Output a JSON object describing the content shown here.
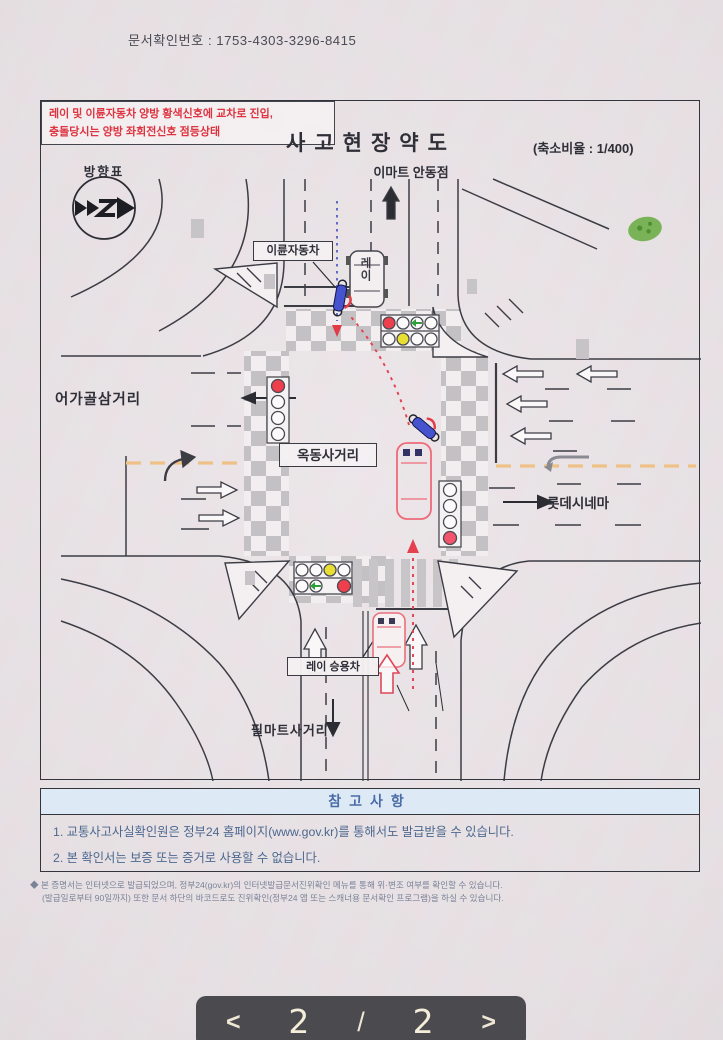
{
  "page": {
    "doc_number": "문서확인번호 : 1753-4303-3296-8415"
  },
  "diagram": {
    "title": "사고현장약도",
    "scale_note": "(축소비율 : 1/400)",
    "compass_label": "방향표",
    "landmark_north": "이마트 안동점",
    "landmark_west": "어가골삼거리",
    "landmark_center": "옥동사거리",
    "landmark_east": "롯데시네마",
    "landmark_south": "필마트사거리",
    "motorcycle_label": "이륜자동차",
    "ray_car_label": "레이 승용차",
    "ray_car_final_text": "레이",
    "incident_line1": "레이 및 이륜자동차 양방 황색신호에 교차로 진입,",
    "incident_line2": "충돌당시는 양방 좌회전신호 점등상태"
  },
  "notes": {
    "header": "참고사항",
    "items": [
      "1. 교통사고사실확인원은 정부24 홈페이지(www.gov.kr)를 통해서도 발급받을 수 있습니다.",
      "2. 본 확인서는 보증 또는 증거로 사용할 수 없습니다."
    ]
  },
  "footnote": {
    "line1": "◆ 본 증명서는 인터넷으로 발급되었으며, 정부24(gov.kr)의 인터넷발급문서진위확인 메뉴를 통해 위·변조 여부를 확인할 수 있습니다.",
    "line2": "(발급일로부터 90일까지) 또한 문서 하단의 바코드로도 진위확인(정부24 앱 또는 스캐너용 문서확인 프로그램)을 하실 수 있습니다."
  },
  "pager": {
    "prev": "<",
    "page": "2",
    "separator": "/",
    "total": "2",
    "next": ">"
  },
  "colors": {
    "accent_red": "#e0323f",
    "signal_yellow": "#e9df33",
    "signal_green": "#2f9e3c",
    "lane_orange": "#eec287",
    "notes_blue": "#4a6da8",
    "pager_bg": "#4b4a4e"
  }
}
